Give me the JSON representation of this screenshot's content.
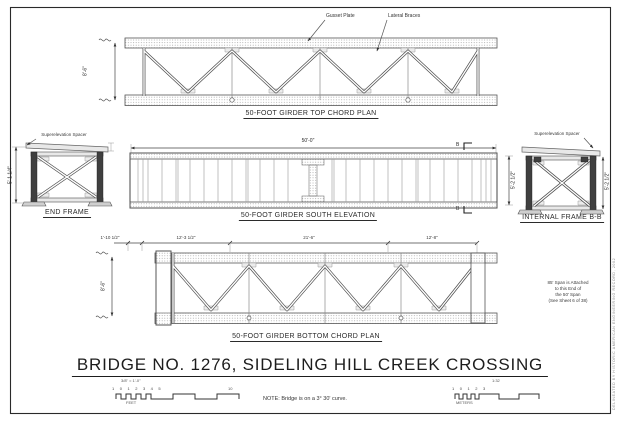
{
  "sheet": {
    "title": "BRIDGE NO. 1276, SIDELING HILL CREEK CROSSING",
    "title_scale_left": "3/8\" = 1'-0\"",
    "title_scale_right": "1:32",
    "note": "NOTE: Bridge is on a 3° 30' curve.",
    "margin_credit": "DELINEATED BY HISTORIC AMERICAN ENGINEERING RECORD, 2002",
    "line_color": "#3a3a3a",
    "paper_color": "#ffffff"
  },
  "top_plan": {
    "caption": "50-FOOT GIRDER TOP CHORD PLAN",
    "gusset_label": "Gusset Plate",
    "lateral_label": "Lateral Braces",
    "width_dim": "8'-6\""
  },
  "elevation": {
    "caption": "50-FOOT GIRDER SOUTH ELEVATION",
    "span_dim": "50'-0\"",
    "depth_dim": "5'-2 1/2\"",
    "section_letter": "B"
  },
  "end_frame": {
    "caption": "END FRAME",
    "spacer_label": "Superelevation Spacer",
    "height_dim": "5'-1 1/4\""
  },
  "internal_frame": {
    "caption": "INTERNAL FRAME B-B",
    "spacer_label": "Superelevation Spacer",
    "height_dim": "5'-2 1/2\""
  },
  "bottom_plan": {
    "caption": "50-FOOT GIRDER BOTTOM CHORD PLAN",
    "dim_1": "1'-10 1/2\"",
    "dim_2": "12'-3 1/2\"",
    "dim_3": "21'-6\"",
    "dim_4": "12'-8\"",
    "width_dim": "8'-6\"",
    "attach_note_line1": "85' Span is Attached",
    "attach_note_line2": "to this End of",
    "attach_note_line3": "the 50' Span",
    "attach_note_line4": "(See Sheet 6 of 38)"
  },
  "scale_bars": {
    "feet_numbers": "1 0 1 2 3 4 5",
    "feet_end_number": "10",
    "feet_unit": "FEET",
    "meters_numbers": "1 0 1 2 3",
    "meters_unit": "METERS"
  }
}
